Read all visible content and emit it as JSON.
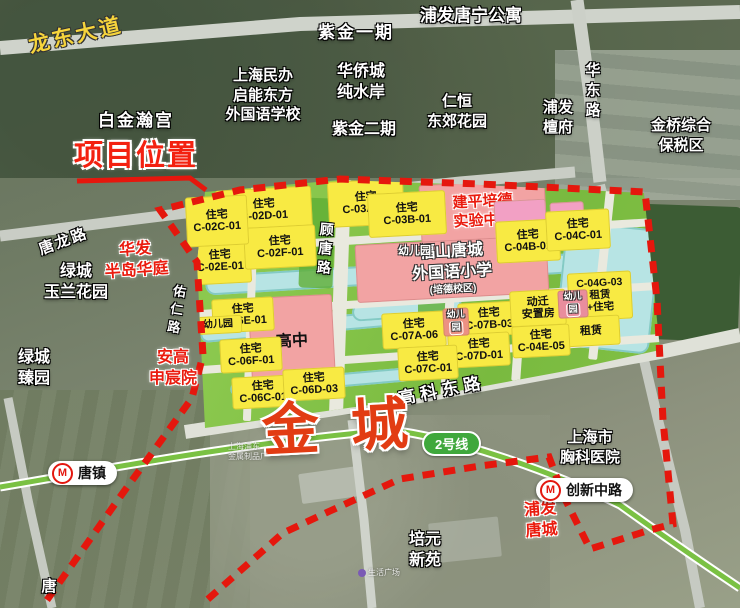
{
  "title_labels": {
    "project_location": "项目位置",
    "area_name": "金城"
  },
  "roads": {
    "longdong_avenue": "龙东大道",
    "tanglong_road": "唐龙路",
    "huadong_road": "华东路",
    "gutang_road": "顾唐路",
    "youren_road": "佑仁路",
    "gaoke_east_road": "高科东路",
    "tang_partial": "唐"
  },
  "metro": {
    "line_badge": "2号线",
    "station_tangzhen": "唐镇",
    "station_chuangxin": "创新中路",
    "logo_letter": "M"
  },
  "estates": {
    "baijinhangong": "白金瀚宫",
    "zijin_phase1": "紫金一期",
    "pufa_tangning": "浦发唐宁公寓",
    "qineng_school_l1": "上海民办",
    "qineng_school_l2": "启能东方",
    "qineng_school_l3": "外国语学校",
    "huaqiaocheng_l1": "华侨城",
    "huaqiaocheng_l2": "纯水岸",
    "zijin_phase2": "紫金二期",
    "renheng_l1": "仁恒",
    "renheng_l2": "东郊花园",
    "pufa_tanfu_l1": "浦发",
    "pufa_tanfu_l2": "檀府",
    "jinqiao_l1": "金桥综合",
    "jinqiao_l2": "保税区",
    "lvcheng_yulan_l1": "绿城",
    "lvcheng_yulan_l2": "玉兰花园",
    "lvcheng_zhen_l1": "绿城",
    "lvcheng_zhen_l2": "臻园",
    "xiongke_l1": "上海市",
    "xiongke_l2": "胸科医院",
    "peiyuan_l1": "培元",
    "peiyuan_l2": "新苑"
  },
  "red_estates": {
    "huafa_l1": "华发",
    "huafa_l2": "半岛华庭",
    "angao_l1": "安高",
    "angao_l2": "申宸院",
    "pufa_tangcheng_l1": "浦发",
    "pufa_tangcheng_l2": "唐城"
  },
  "schools": {
    "jianping_l1": "建平培德",
    "jianping_l2": "实验中学",
    "fushan_l1": "福山唐城",
    "fushan_l2": "外国语小学",
    "fushan_l3": "(培德校区)",
    "high_school": "高中",
    "kindergarten": "幼儿园",
    "kinder_l1": "幼儿",
    "kinder_l2": "园"
  },
  "plots": {
    "res": "住宅",
    "c02c": "C-02C-01",
    "c02d": "C-02D-01",
    "c02e": "C-02E-01",
    "c02f": "C-02F-01",
    "c03a": "C-03A-01",
    "c03b": "C-03B-01",
    "c04b": "C-04B-01",
    "c04c": "C-04C-01",
    "c04g": "C-04G-03",
    "c04e5": "C-04E-05",
    "c06c": "C-06C-01",
    "c06d": "C-06D-03",
    "c06e": "C-06E-01",
    "c06f": "C-06F-01",
    "c07a": "C-07A-06",
    "c07b": "C-07B-03",
    "c07c": "C-07C-01",
    "c07d": "C-07D-01",
    "rental": "租赁",
    "rental_plus": "+住宅",
    "relocation_l1": "动迁",
    "relocation_l2": "安置房"
  },
  "faint_labels": {
    "factory_l1": "上海浦东",
    "factory_l2": "金属制品厂",
    "plaza": "生活广场"
  }
}
